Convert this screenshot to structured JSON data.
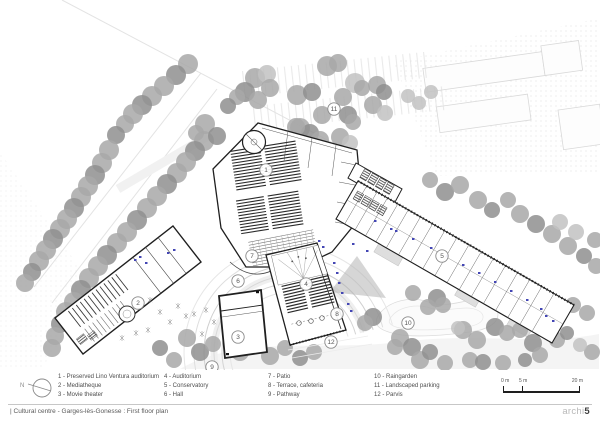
{
  "footer": {
    "title": "| Cultural centre - Garges-lès-Gonesse : First floor plan",
    "logo_light": "archi",
    "logo_bold": "5"
  },
  "north": {
    "label": "N"
  },
  "legend": {
    "items": [
      {
        "text": "1 - Preserved Lino Ventura auditorium"
      },
      {
        "text": "2 - Mediatheque"
      },
      {
        "text": "3 - Movie theater"
      },
      {
        "text": "4 - Auditorium"
      },
      {
        "text": "5 - Conservatory"
      },
      {
        "text": "6 - Hall"
      },
      {
        "text": "7 - Patio"
      },
      {
        "text": "8 - Terrace, cafeteria"
      },
      {
        "text": "9 - Pathway"
      },
      {
        "text": "10 - Raingarden"
      },
      {
        "text": "11 - Landscaped parking"
      },
      {
        "text": "12 - Parvis"
      }
    ]
  },
  "scalebar": {
    "start": "0 m",
    "mid": "5 m",
    "end": "20 m"
  },
  "plan": {
    "markers": [
      {
        "n": "1",
        "x": 266,
        "y": 170
      },
      {
        "n": "2",
        "x": 138,
        "y": 303
      },
      {
        "n": "3",
        "x": 238,
        "y": 337
      },
      {
        "n": "4",
        "x": 306,
        "y": 284
      },
      {
        "n": "5",
        "x": 442,
        "y": 256
      },
      {
        "n": "6",
        "x": 238,
        "y": 281
      },
      {
        "n": "7",
        "x": 252,
        "y": 256
      },
      {
        "n": "8",
        "x": 337,
        "y": 314
      },
      {
        "n": "9",
        "x": 212,
        "y": 367
      },
      {
        "n": "10",
        "x": 408,
        "y": 323
      },
      {
        "n": "11",
        "x": 334,
        "y": 109
      },
      {
        "n": "12",
        "x": 331,
        "y": 342
      }
    ],
    "trees": [
      [
        188,
        64,
        10,
        1
      ],
      [
        176,
        75,
        10,
        0
      ],
      [
        164,
        86,
        10,
        1
      ],
      [
        152,
        96,
        10,
        1
      ],
      [
        142,
        105,
        10,
        0
      ],
      [
        133,
        114,
        10,
        1
      ],
      [
        125,
        124,
        9,
        1
      ],
      [
        116,
        135,
        9,
        0
      ],
      [
        109,
        150,
        10,
        1
      ],
      [
        102,
        163,
        10,
        1
      ],
      [
        95,
        175,
        10,
        0
      ],
      [
        88,
        186,
        10,
        1
      ],
      [
        81,
        197,
        10,
        1
      ],
      [
        74,
        208,
        10,
        0
      ],
      [
        67,
        219,
        10,
        1
      ],
      [
        60,
        229,
        10,
        1
      ],
      [
        53,
        239,
        10,
        0
      ],
      [
        46,
        250,
        10,
        1
      ],
      [
        39,
        261,
        10,
        1
      ],
      [
        32,
        272,
        9,
        0
      ],
      [
        25,
        283,
        9,
        1
      ],
      [
        204,
        141,
        10,
        1
      ],
      [
        195,
        151,
        10,
        0
      ],
      [
        186,
        162,
        10,
        1
      ],
      [
        177,
        173,
        10,
        1
      ],
      [
        167,
        184,
        10,
        0
      ],
      [
        157,
        196,
        10,
        1
      ],
      [
        147,
        208,
        10,
        1
      ],
      [
        137,
        220,
        10,
        0
      ],
      [
        127,
        232,
        10,
        1
      ],
      [
        117,
        243,
        10,
        1
      ],
      [
        107,
        255,
        10,
        0
      ],
      [
        98,
        266,
        10,
        1
      ],
      [
        89,
        278,
        10,
        1
      ],
      [
        81,
        290,
        10,
        0
      ],
      [
        74,
        302,
        10,
        1
      ],
      [
        66,
        312,
        10,
        1
      ],
      [
        60,
        324,
        9,
        0
      ],
      [
        55,
        336,
        9,
        1
      ],
      [
        52,
        348,
        9,
        1
      ],
      [
        205,
        124,
        10,
        1
      ],
      [
        217,
        136,
        9,
        0
      ],
      [
        196,
        133,
        8,
        1
      ],
      [
        255,
        78,
        10,
        1
      ],
      [
        267,
        74,
        9,
        2
      ],
      [
        245,
        92,
        10,
        0
      ],
      [
        258,
        100,
        9,
        1
      ],
      [
        270,
        88,
        9,
        1
      ],
      [
        297,
        95,
        10,
        1
      ],
      [
        312,
        92,
        9,
        0
      ],
      [
        327,
        66,
        10,
        1
      ],
      [
        338,
        63,
        9,
        1
      ],
      [
        355,
        83,
        10,
        2
      ],
      [
        362,
        88,
        8,
        1
      ],
      [
        377,
        85,
        9,
        1
      ],
      [
        384,
        92,
        8,
        0
      ],
      [
        343,
        97,
        9,
        1
      ],
      [
        373,
        105,
        9,
        1
      ],
      [
        385,
        113,
        8,
        2
      ],
      [
        322,
        115,
        9,
        1
      ],
      [
        348,
        115,
        9,
        0
      ],
      [
        353,
        122,
        8,
        1
      ],
      [
        300,
        128,
        10,
        1
      ],
      [
        310,
        133,
        9,
        0
      ],
      [
        320,
        140,
        9,
        1
      ],
      [
        340,
        137,
        9,
        1
      ],
      [
        350,
        143,
        8,
        2
      ],
      [
        307,
        157,
        9,
        1
      ],
      [
        317,
        163,
        9,
        0
      ],
      [
        327,
        170,
        9,
        1
      ],
      [
        337,
        177,
        9,
        1
      ],
      [
        293,
        173,
        9,
        2
      ],
      [
        283,
        180,
        9,
        1
      ],
      [
        296,
        127,
        9,
        1
      ],
      [
        237,
        97,
        8,
        1
      ],
      [
        228,
        106,
        8,
        0
      ],
      [
        408,
        96,
        7,
        2
      ],
      [
        419,
        103,
        7,
        2
      ],
      [
        431,
        92,
        7,
        2
      ],
      [
        430,
        180,
        8,
        1
      ],
      [
        445,
        192,
        9,
        0
      ],
      [
        460,
        185,
        9,
        1
      ],
      [
        478,
        200,
        9,
        1
      ],
      [
        492,
        210,
        8,
        0
      ],
      [
        508,
        200,
        8,
        1
      ],
      [
        520,
        214,
        9,
        1
      ],
      [
        536,
        224,
        9,
        0
      ],
      [
        552,
        234,
        9,
        1
      ],
      [
        568,
        246,
        9,
        1
      ],
      [
        584,
        256,
        8,
        0
      ],
      [
        596,
        266,
        8,
        1
      ],
      [
        576,
        232,
        8,
        2
      ],
      [
        560,
        222,
        8,
        2
      ],
      [
        595,
        240,
        8,
        1
      ],
      [
        413,
        293,
        8,
        1
      ],
      [
        437,
        298,
        9,
        0
      ],
      [
        443,
        305,
        8,
        1
      ],
      [
        428,
        307,
        8,
        1
      ],
      [
        373,
        317,
        9,
        0
      ],
      [
        365,
        323,
        8,
        1
      ],
      [
        400,
        338,
        9,
        1
      ],
      [
        412,
        347,
        9,
        0
      ],
      [
        395,
        347,
        8,
        1
      ],
      [
        420,
        360,
        9,
        1
      ],
      [
        430,
        352,
        8,
        0
      ],
      [
        463,
        330,
        9,
        1
      ],
      [
        477,
        340,
        9,
        1
      ],
      [
        495,
        327,
        9,
        0
      ],
      [
        507,
        333,
        8,
        1
      ],
      [
        520,
        330,
        8,
        1
      ],
      [
        533,
        343,
        9,
        0
      ],
      [
        542,
        328,
        8,
        1
      ],
      [
        557,
        315,
        9,
        1
      ],
      [
        563,
        308,
        8,
        0
      ],
      [
        573,
        305,
        8,
        1
      ],
      [
        557,
        340,
        8,
        1
      ],
      [
        567,
        333,
        7,
        0
      ],
      [
        587,
        313,
        8,
        1
      ],
      [
        470,
        360,
        8,
        1
      ],
      [
        483,
        362,
        8,
        0
      ],
      [
        503,
        363,
        8,
        1
      ],
      [
        458,
        328,
        7,
        2
      ],
      [
        445,
        363,
        8,
        1
      ],
      [
        540,
        355,
        8,
        1
      ],
      [
        525,
        360,
        7,
        0
      ],
      [
        592,
        352,
        8,
        1
      ],
      [
        580,
        345,
        7,
        2
      ],
      [
        240,
        352,
        9,
        1
      ],
      [
        255,
        342,
        8,
        0
      ],
      [
        270,
        356,
        9,
        1
      ],
      [
        285,
        348,
        8,
        1
      ],
      [
        300,
        358,
        8,
        0
      ],
      [
        187,
        338,
        9,
        1
      ],
      [
        200,
        352,
        9,
        0
      ],
      [
        174,
        360,
        8,
        1
      ],
      [
        213,
        344,
        8,
        1
      ],
      [
        160,
        348,
        8,
        0
      ],
      [
        314,
        352,
        8,
        1
      ]
    ],
    "colors": {
      "tree_dark": "#8f8f8f",
      "tree_mid": "#a8a8a8",
      "tree_light": "#c2c2c2",
      "wall": "#1f1f1f",
      "accent_blue": "#4346b4",
      "marker_stroke": "#8a8a8a",
      "marker_text": "#555555"
    }
  }
}
